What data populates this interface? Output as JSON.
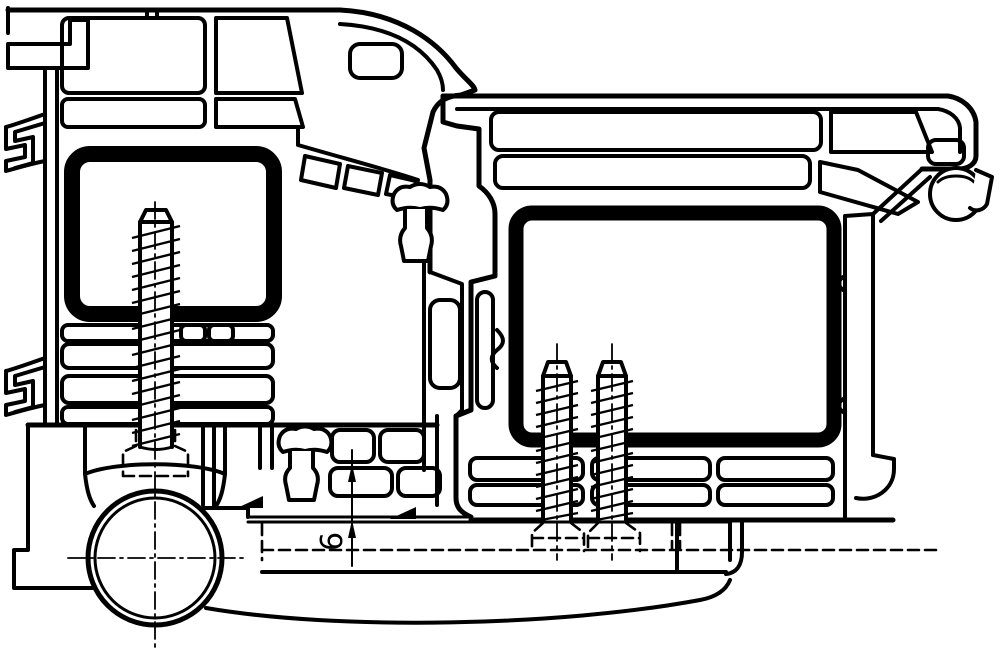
{
  "drawing": {
    "title_semantic": "door-hinge-profile-cross-section",
    "dimension_label": "6",
    "line_color": "#000000",
    "background_color": "#ffffff"
  }
}
